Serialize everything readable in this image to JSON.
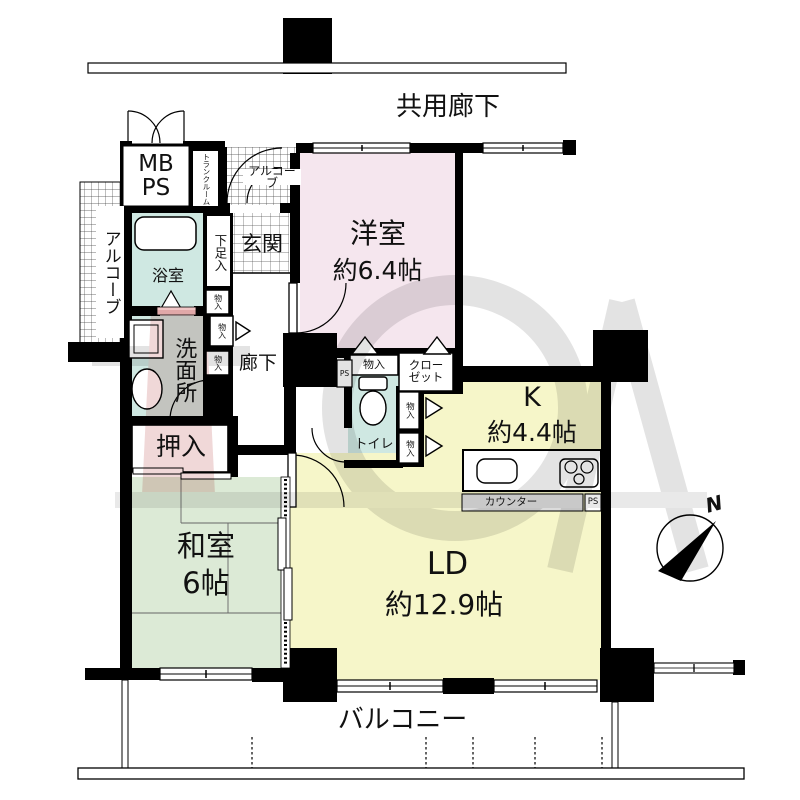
{
  "plan_title": "マンション間取り図",
  "rooms": {
    "corridor": {
      "name": "共用廊下"
    },
    "western": {
      "name": "洋室",
      "size": "約6.4帖"
    },
    "japanese": {
      "name": "和室",
      "size": "6帖"
    },
    "living": {
      "name": "LD",
      "size": "約12.9帖"
    },
    "kitchen": {
      "name": "K",
      "size": "約4.4帖"
    },
    "bath": {
      "name": "浴室"
    },
    "washroom": {
      "name": "洗面所"
    },
    "toilet": {
      "name": "トイレ"
    },
    "entrance": {
      "name": "玄関"
    },
    "hallway": {
      "name": "廊下"
    },
    "oshiire": {
      "name": "押入"
    },
    "balcony": {
      "name": "バルコニー"
    },
    "alcove_entry": {
      "name": "アルコーブ"
    },
    "alcove_side": {
      "name": "アルコーブ"
    }
  },
  "fixtures": {
    "meter_box": "MB\nPS",
    "trunk_room": "トランクルーム",
    "shoe_box": "下足入",
    "storage": "物入",
    "closet": "クロー\nゼット",
    "counter": "カウンター",
    "pipe_space": "PS"
  },
  "compass": {
    "north": "N"
  },
  "watermark": "TOA",
  "colors": {
    "western_room": "#f5e6ee",
    "tatami_room": "#dcead6",
    "living_kitchen": "#f6f6c9",
    "wet_area": "#cfe8e2",
    "door_sill": "#f0c6c6",
    "counter_strip": "#dcdcdc",
    "wall": "#000000",
    "watermark_grey": "#e3e3e3",
    "watermark_pink": "#f0d8d8"
  }
}
